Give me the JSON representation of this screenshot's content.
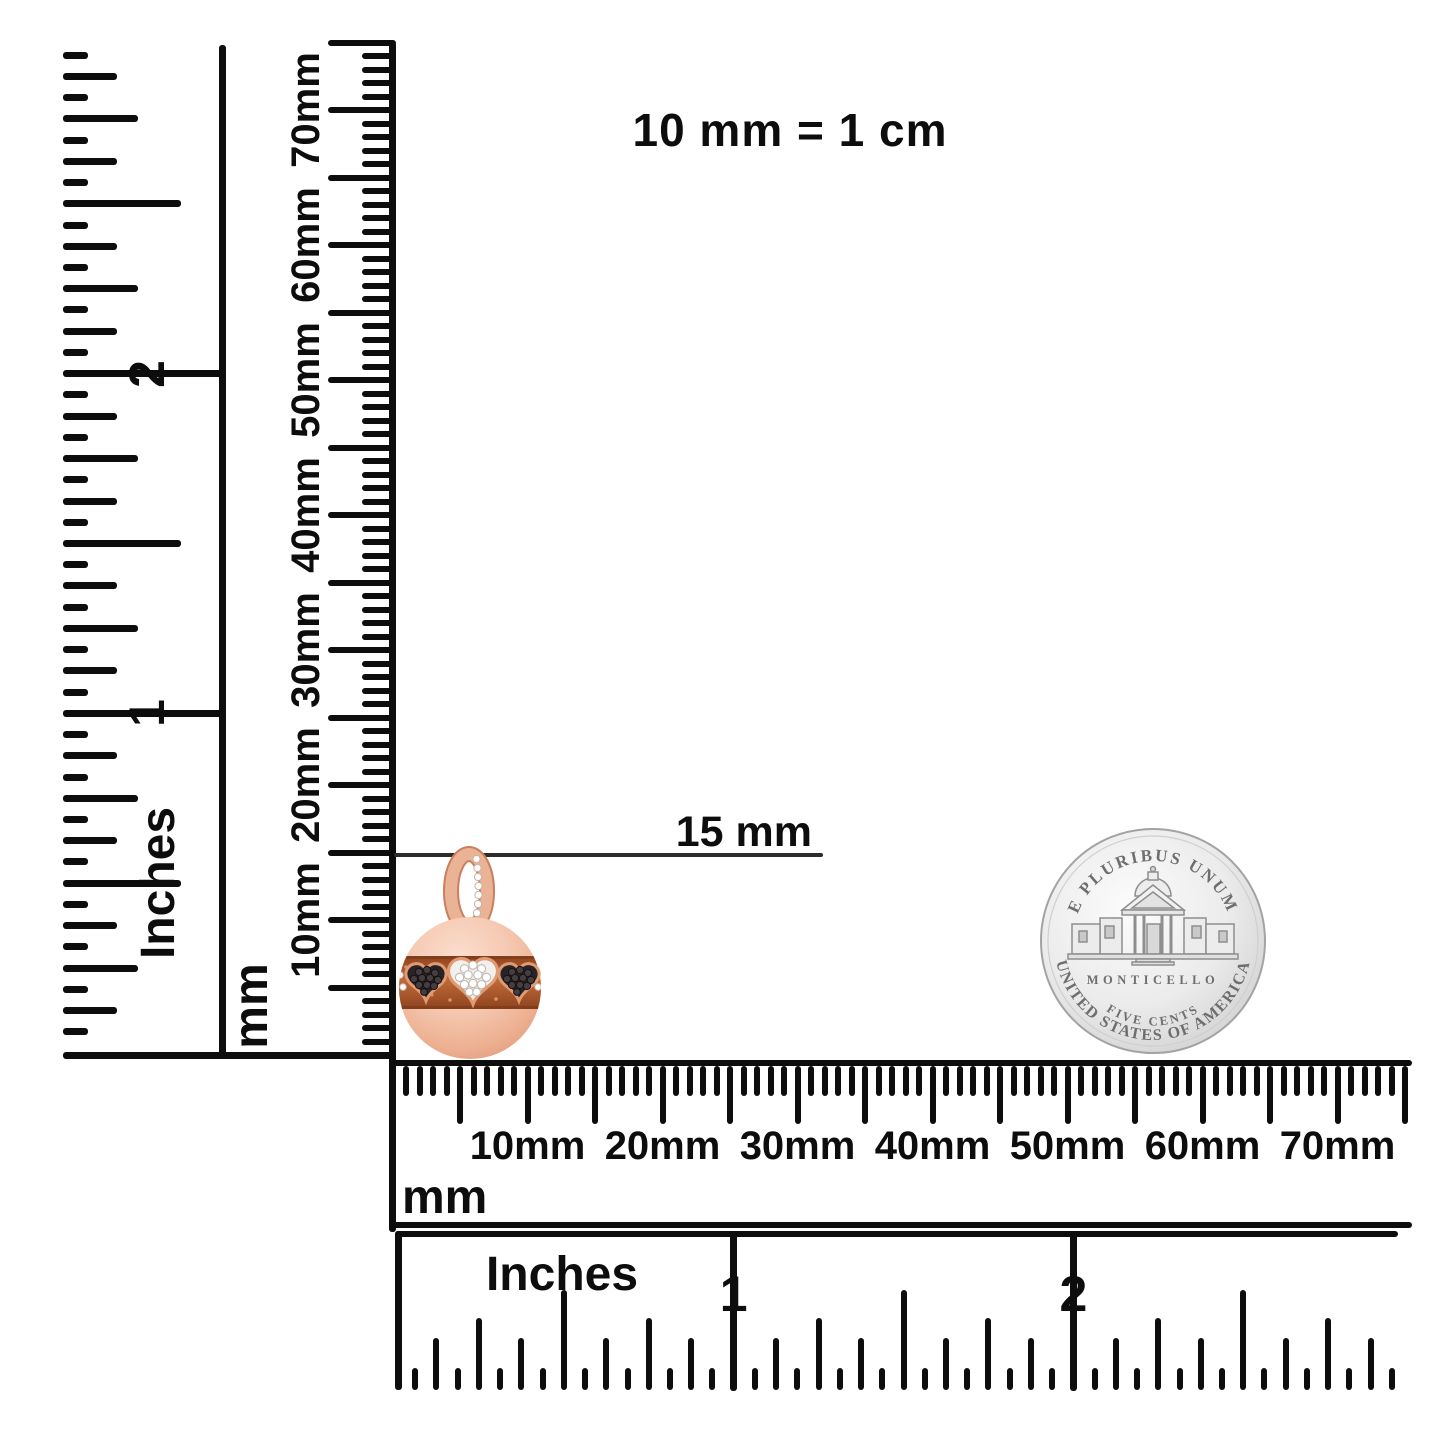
{
  "scale_note": "10 mm = 1 cm",
  "measurement": {
    "label": "15 mm"
  },
  "rulers": {
    "left_inches": {
      "unit": "Inches",
      "numerals": [
        "1",
        "2"
      ]
    },
    "left_mm": {
      "unit": "mm",
      "labels": [
        "10mm",
        "20mm",
        "30mm",
        "40mm",
        "50mm",
        "60mm",
        "70mm"
      ]
    },
    "bottom_mm": {
      "unit": "mm",
      "labels": [
        "10mm",
        "20mm",
        "30mm",
        "40mm",
        "50mm",
        "60mm",
        "70mm"
      ]
    },
    "bottom_inches": {
      "unit": "Inches",
      "numerals": [
        "1",
        "2"
      ]
    }
  },
  "charm": {
    "description": "rose gold ball charm with black and white diamond hearts",
    "colors": {
      "rose_gold_light": "#fbdecf",
      "rose_gold": "#f3c6ae",
      "rose_gold_deep": "#e09a7c",
      "band_copper": "#a65630",
      "heart_outline": "#e09a74",
      "black_heart": "#282325",
      "white_stone": "#ffffff"
    }
  },
  "coin": {
    "legend_top": "E PLURIBUS UNUM",
    "building_label": "MONTICELLO",
    "denomination": "FIVE CENTS",
    "legend_bottom": "UNITED STATES OF AMERICA",
    "color": "#d9d9d9"
  }
}
